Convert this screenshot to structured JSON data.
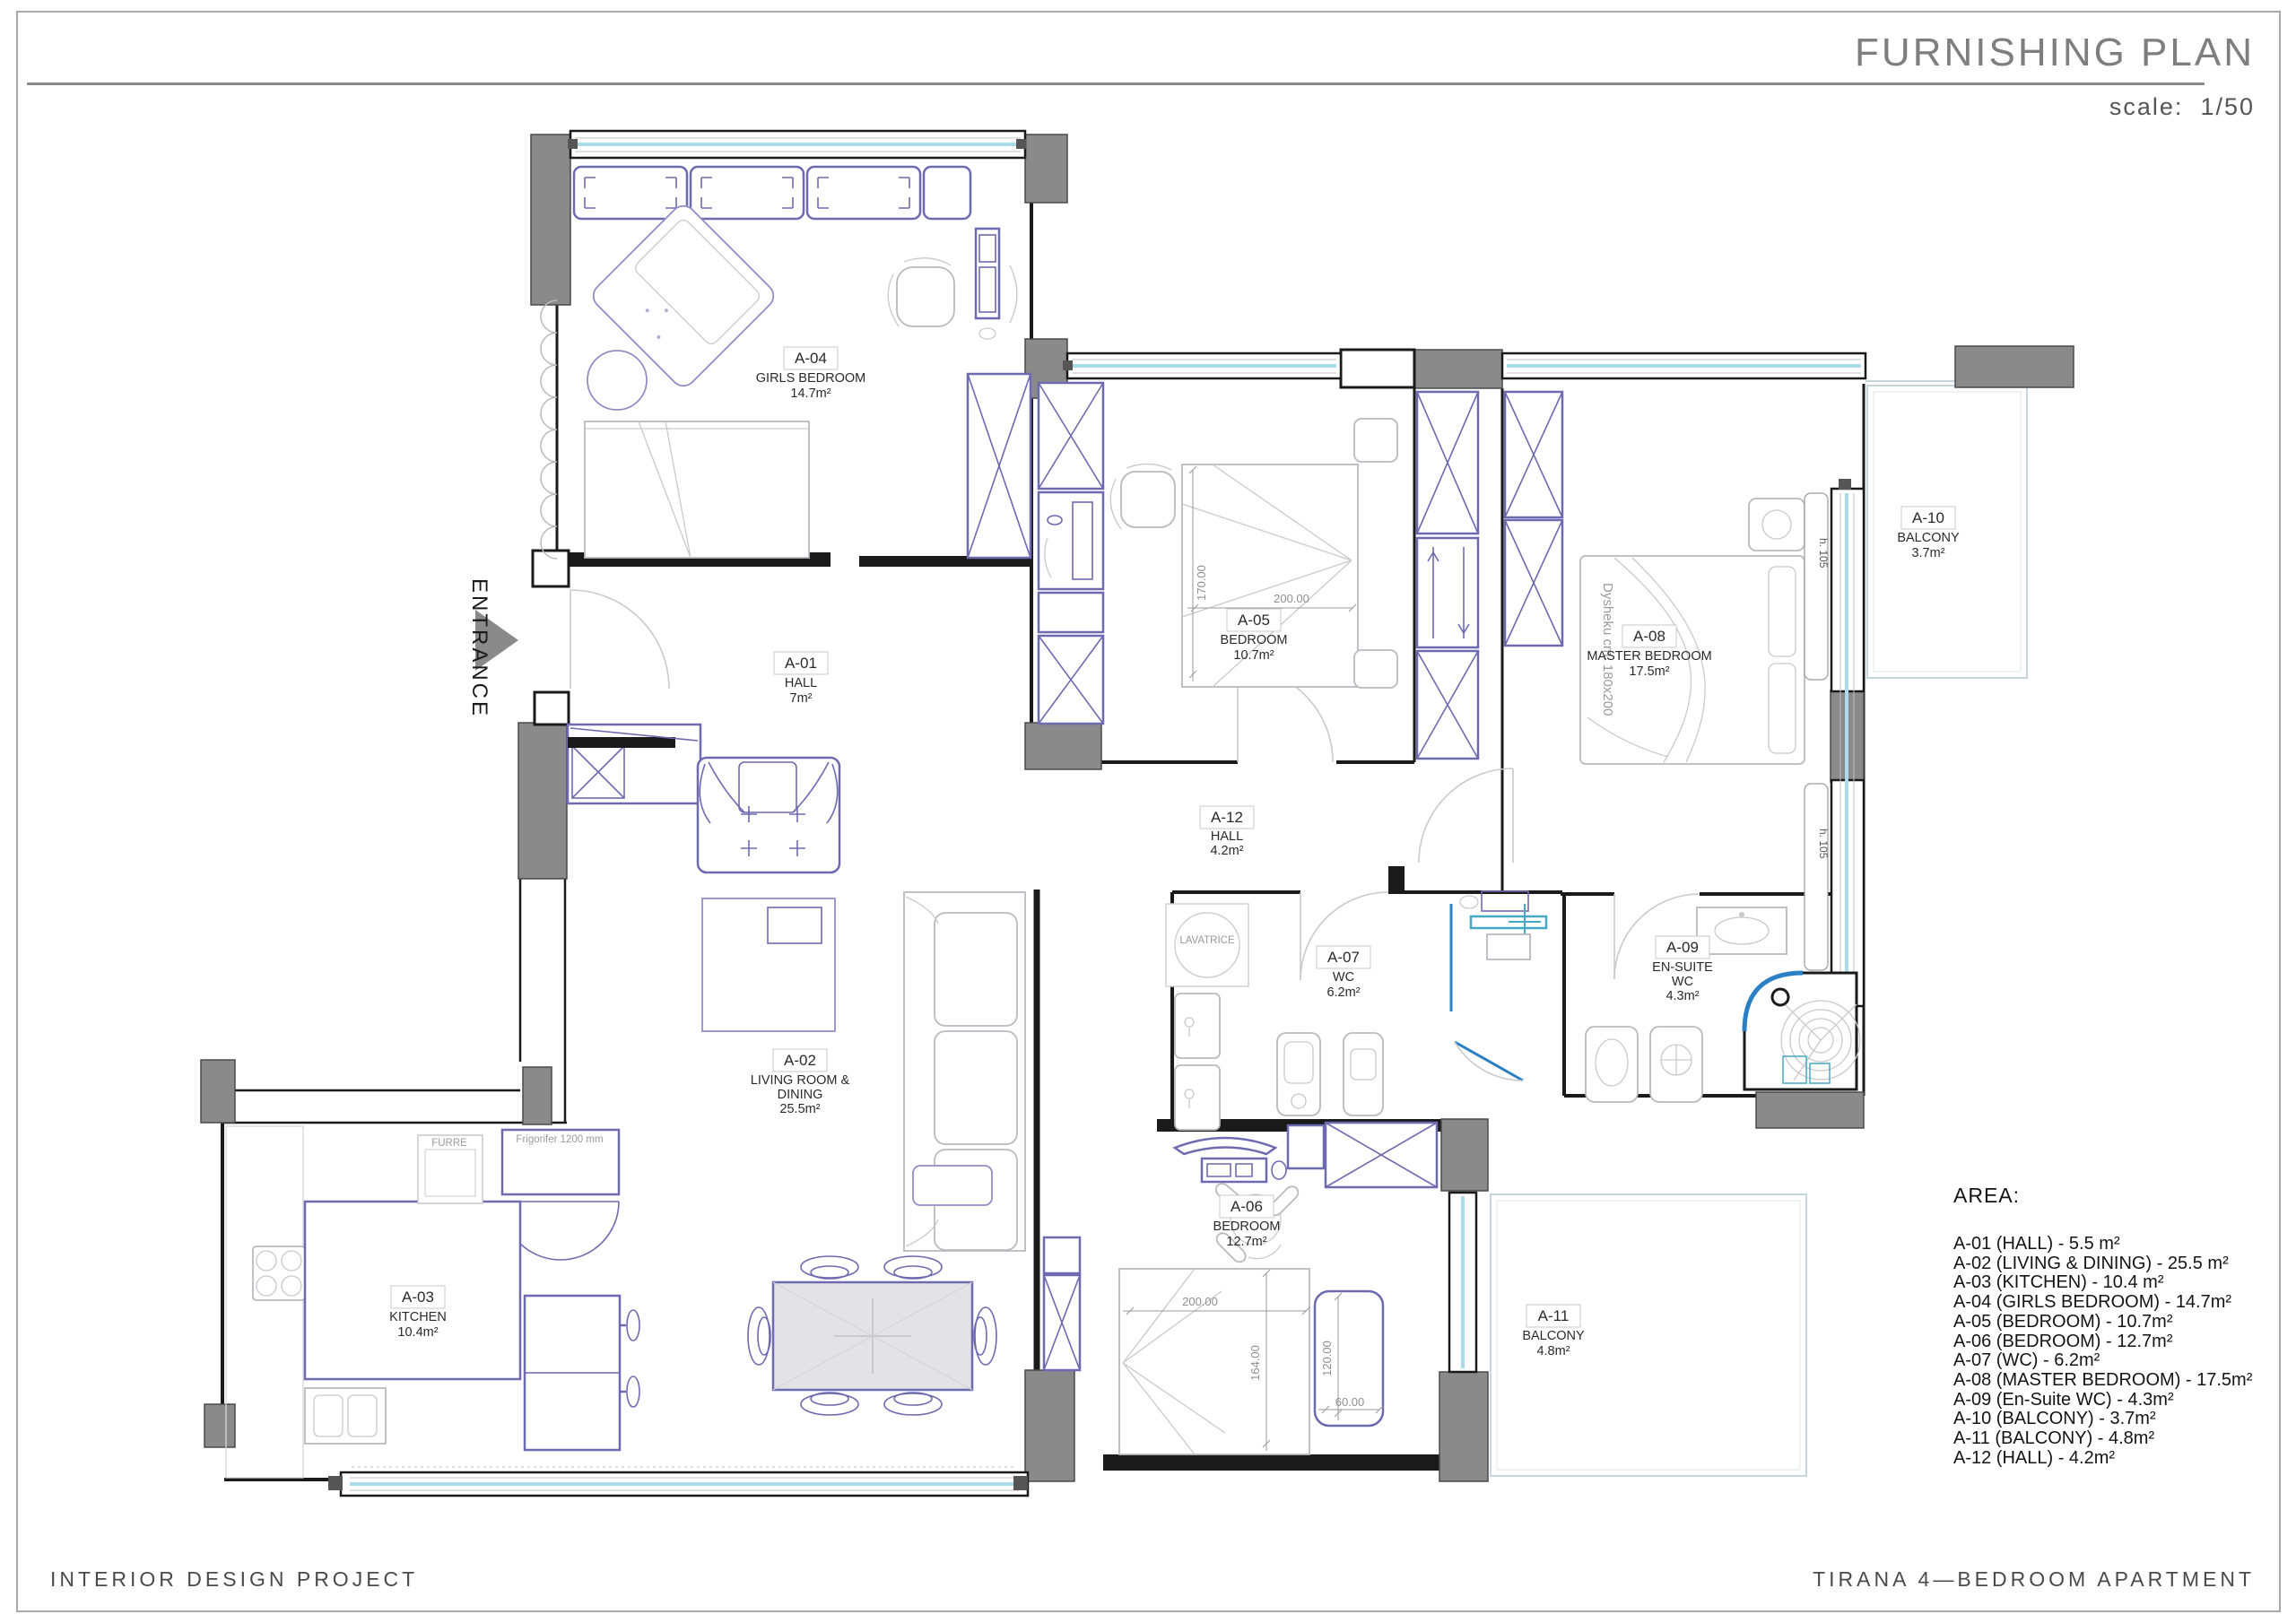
{
  "header": {
    "title": "FURNISHING PLAN",
    "scale": "scale:  1/50"
  },
  "footer": {
    "left": "INTERIOR DESIGN PROJECT",
    "right": "TIRANA 4—BEDROOM APARTMENT"
  },
  "legend": {
    "heading": "AREA:",
    "items": [
      "A-01 (HALL) - 5.5 m²",
      "A-02 (LIVING & DINING) - 25.5 m²",
      "A-03 (KITCHEN) - 10.4 m²",
      "A-04 (GIRLS BEDROOM) - 14.7m²",
      "A-05 (BEDROOM) - 10.7m²",
      "A-06 (BEDROOM) - 12.7m²",
      "A-07 (WC) - 6.2m²",
      "A-08 (MASTER BEDROOM) - 17.5m²",
      "A-09 (En-Suite WC) - 4.3m²",
      "A-10 (BALCONY) - 3.7m²",
      "A-11 (BALCONY) - 4.8m²",
      "A-12 (HALL) - 4.2m²"
    ]
  },
  "rooms": {
    "a01": {
      "code": "A-01",
      "name": "HALL",
      "area": "7m²"
    },
    "a02": {
      "code": "A-02",
      "name_line1": "LIVING ROOM &",
      "name_line2": "DINING",
      "area": "25.5m²"
    },
    "a03": {
      "code": "A-03",
      "name": "KITCHEN",
      "area": "10.4m²"
    },
    "a04": {
      "code": "A-04",
      "name": "GIRLS BEDROOM",
      "area": "14.7m²"
    },
    "a05": {
      "code": "A-05",
      "name": "BEDROOM",
      "area": "10.7m²"
    },
    "a06": {
      "code": "A-06",
      "name": "BEDROOM",
      "area": "12.7m²"
    },
    "a07": {
      "code": "A-07",
      "name": "WC",
      "area": "6.2m²"
    },
    "a08": {
      "code": "A-08",
      "name": "MASTER BEDROOM",
      "area": "17.5m²"
    },
    "a09": {
      "code": "A-09",
      "name_line1": "EN-SUITE",
      "name_line2": "WC",
      "area": "4.3m²"
    },
    "a10": {
      "code": "A-10",
      "name": "BALCONY",
      "area": "3.7m²"
    },
    "a11": {
      "code": "A-11",
      "name": "BALCONY",
      "area": "4.8m²"
    },
    "a12": {
      "code": "A-12",
      "name": "HALL",
      "area": "4.2m²"
    }
  },
  "annotations": {
    "entrance": "ENTRANCE",
    "mattress": "Dysheku  cm.  180x200",
    "washer": "LAVATRICE",
    "oven": "FURRE",
    "fridge": "Frigorifer 1200 mm",
    "window_height": "h. 105"
  },
  "dimensions": {
    "bed_a05_width": "170.00",
    "bed_a05_length": "200.00",
    "bed_a06_length": "200.00",
    "bed_a06_width": "164.00",
    "bench_length": "120.00",
    "bench_width": "60.00"
  },
  "colors": {
    "wall": "#1a1a1a",
    "column": "#8a8a8a",
    "furniture_purple": "#6e6ab0",
    "furniture_gray": "#b9b9c0",
    "window_glass": "#a9dbe9",
    "glazing_blue": "#2b7fc4"
  }
}
